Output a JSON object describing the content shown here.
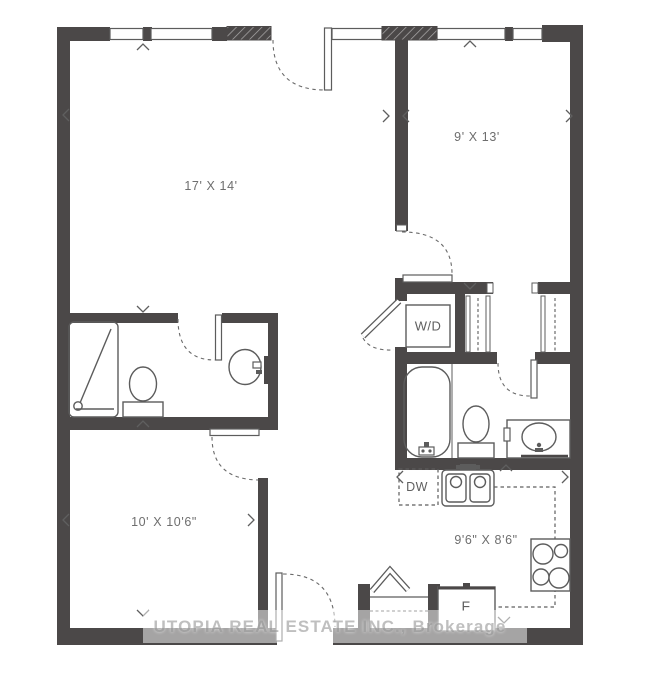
{
  "watermark": "UTOPIA REAL ESTATE INC., Brokerage",
  "rooms": {
    "living": {
      "dims": "17' X 14'"
    },
    "bedroom2": {
      "dims": "9' X 13'"
    },
    "bedroom1": {
      "dims": "10' X 10'6\""
    },
    "kitchen": {
      "dims": "9'6\" X 8'6\""
    }
  },
  "labels": {
    "washer_dryer": "W/D",
    "dishwasher": "DW",
    "fridge": "F"
  },
  "colors": {
    "wall": "#4b4848",
    "fixture_line": "#5c5c5c",
    "dashed_line": "#6a6a6a",
    "dimension_text": "#6e6e6e",
    "watermark_text": "#a2a2a2"
  }
}
